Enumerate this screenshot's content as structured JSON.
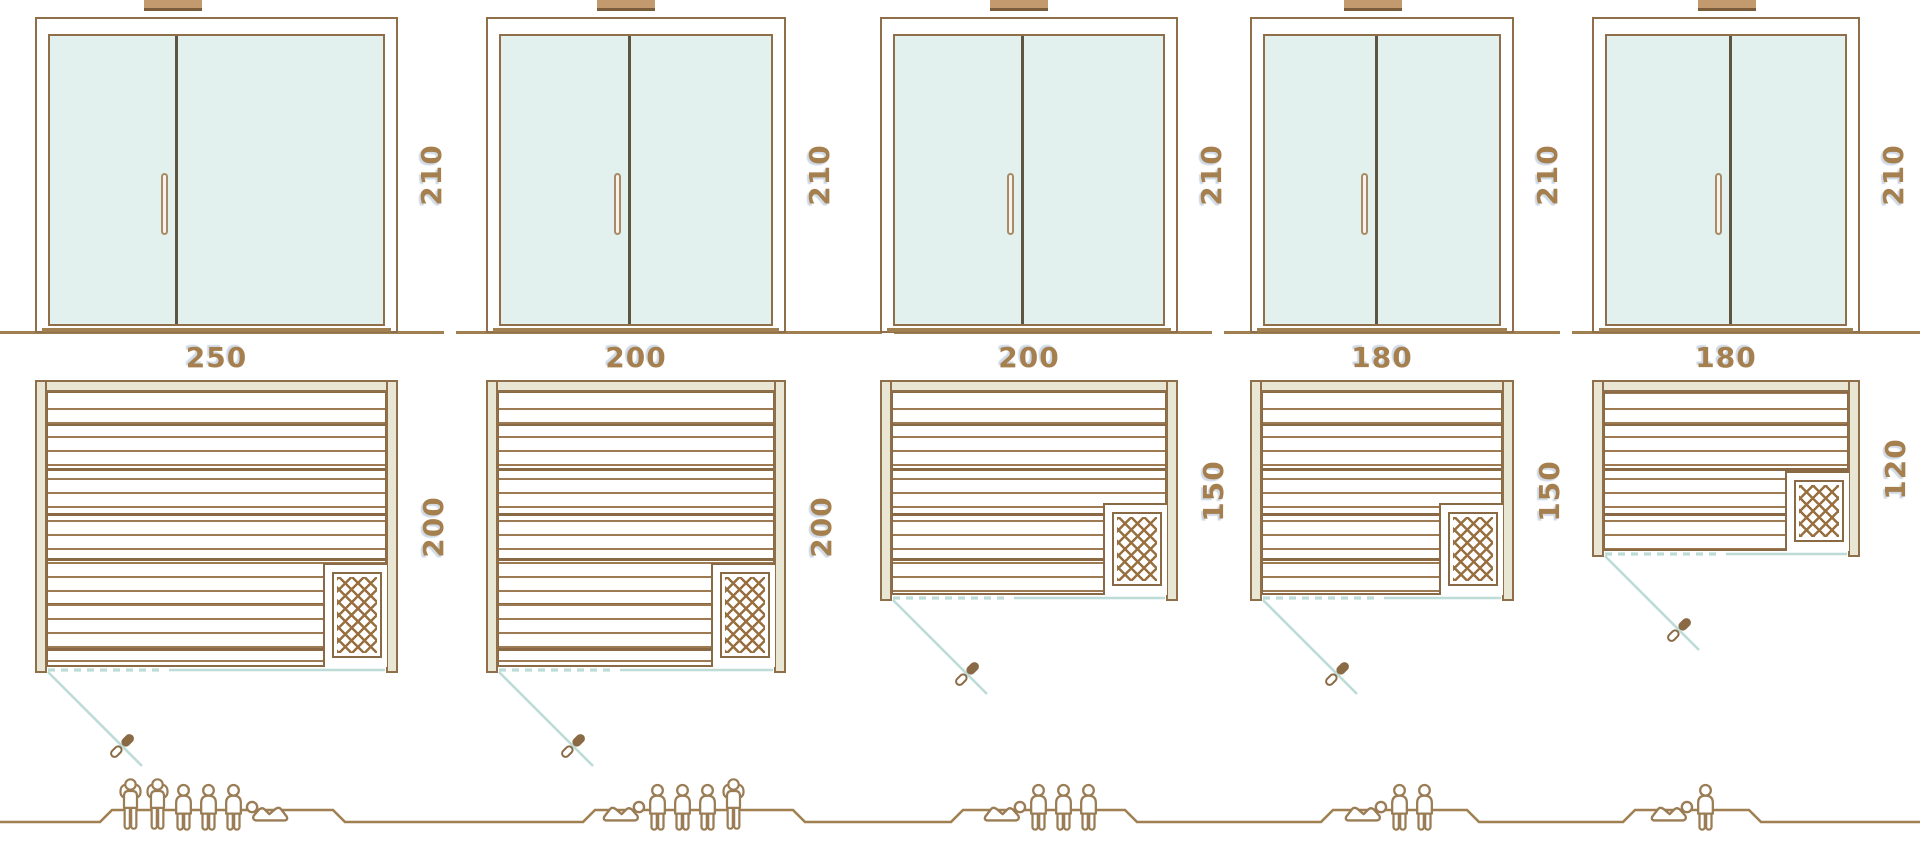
{
  "diagram": {
    "kind": "sauna size comparison",
    "rows": [
      "door-elevation",
      "floor-plan",
      "capacity-figures"
    ]
  },
  "colors": {
    "outline": "#8a6a45",
    "frame_fill": "#e9e6d3",
    "glass": "#e2f1ee",
    "divider": "#5e5442",
    "teal_line": "#bddcd8",
    "label": "#a5804e",
    "ground": "#a07f50",
    "figure_outline": "#9a7c55",
    "mesh": "#996f3f",
    "vent_fill": "#c39a6d",
    "vent_edge": "#7b5c3b",
    "handle_fill": "#f7f3ea",
    "handle_border": "#a88b66"
  },
  "icons": [
    "roof-vent-icon",
    "door-handle-icon",
    "heater-icon",
    "door-swing-line",
    "door-swing-handle-icon",
    "person-standing-icon",
    "person-sitting-icon",
    "person-lying-icon"
  ],
  "units": [
    {
      "name": "sauna-250x200",
      "width_cm": "250",
      "depth_cm": "200",
      "height_cm": "210",
      "capacity": 6,
      "people": [
        "standing",
        "standing",
        "sitting",
        "sitting",
        "sitting",
        "lying"
      ],
      "lying_head": "left",
      "layout": {
        "x": 35,
        "w": 363,
        "plan_h": 293,
        "divider": 0.37,
        "heater_h": 104,
        "platform": [
          112,
          333
        ],
        "people_x0": 116
      }
    },
    {
      "name": "sauna-200x200",
      "width_cm": "200",
      "depth_cm": "200",
      "height_cm": "210",
      "capacity": 5,
      "people": [
        "lying",
        "sitting",
        "sitting",
        "sitting",
        "standing"
      ],
      "lying_head": "right",
      "layout": {
        "x": 486,
        "w": 300,
        "plan_h": 293,
        "divider": 0.46,
        "heater_h": 104,
        "platform": [
          595,
          793
        ],
        "people_x0": 602
      }
    },
    {
      "name": "sauna-200x150",
      "width_cm": "200",
      "depth_cm": "150",
      "height_cm": "210",
      "capacity": 4,
      "people": [
        "lying",
        "sitting",
        "sitting",
        "sitting"
      ],
      "lying_head": "right",
      "layout": {
        "x": 880,
        "w": 298,
        "plan_h": 221,
        "divider": 0.46,
        "heater_h": 92,
        "platform": [
          963,
          1125
        ],
        "people_x0": 983
      }
    },
    {
      "name": "sauna-180x150",
      "width_cm": "180",
      "depth_cm": "150",
      "height_cm": "210",
      "capacity": 3,
      "people": [
        "lying",
        "sitting",
        "sitting"
      ],
      "lying_head": "right",
      "layout": {
        "x": 1250,
        "w": 264,
        "plan_h": 221,
        "divider": 0.46,
        "heater_h": 92,
        "platform": [
          1333,
          1467
        ],
        "people_x0": 1344
      }
    },
    {
      "name": "sauna-180x120",
      "width_cm": "180",
      "depth_cm": "120",
      "height_cm": "210",
      "capacity": 2,
      "people": [
        "lying",
        "sitting"
      ],
      "lying_head": "right",
      "layout": {
        "x": 1592,
        "w": 268,
        "plan_h": 177,
        "divider": 0.5,
        "heater_h": 80,
        "platform": [
          1635,
          1749
        ],
        "people_x0": 1650
      }
    }
  ],
  "ground_segments": [
    [
      0,
      444
    ],
    [
      456,
      882
    ],
    [
      894,
      1212
    ],
    [
      1224,
      1560
    ],
    [
      1572,
      1920
    ]
  ],
  "elevation": {
    "top": 17,
    "height": 316
  }
}
